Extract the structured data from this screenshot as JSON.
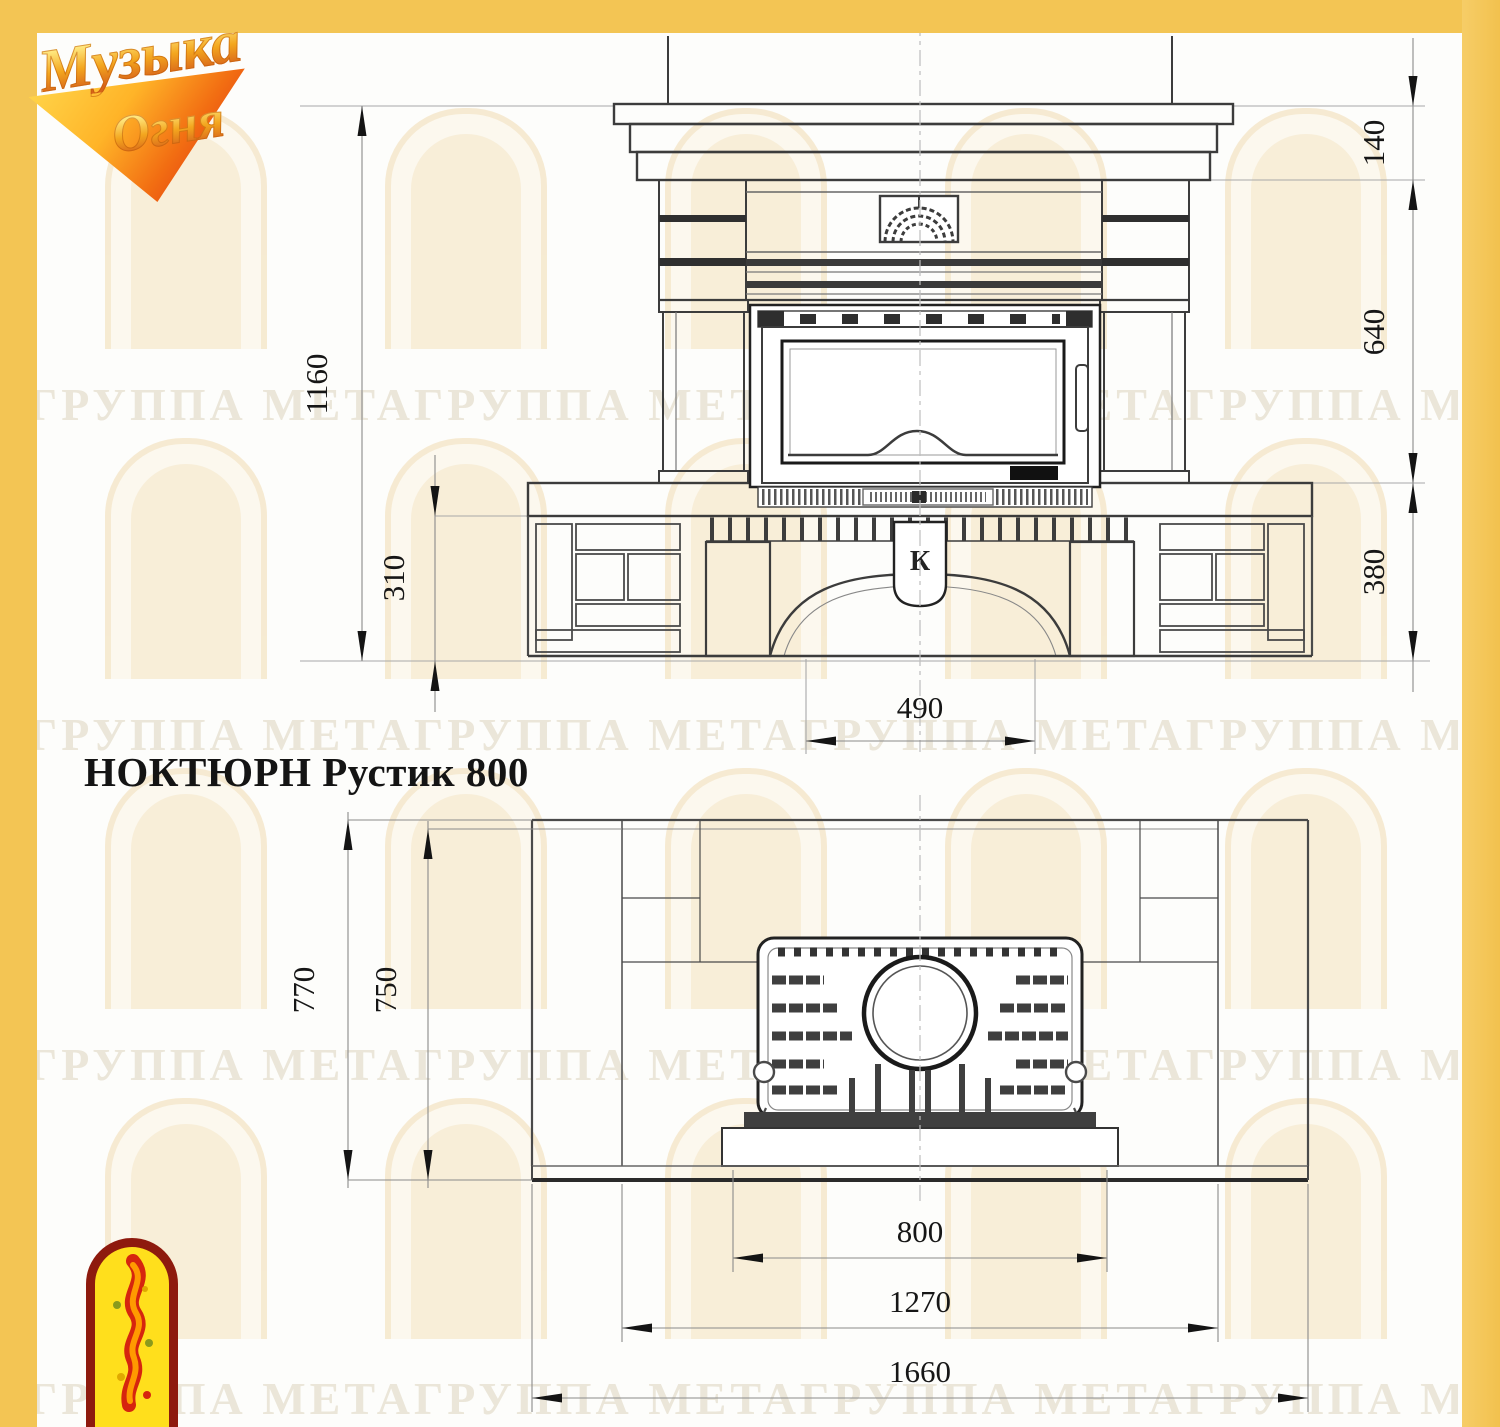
{
  "frame": {
    "color": "#f3c554"
  },
  "logo": {
    "word1": "Музыка",
    "word2": "Огня"
  },
  "watermark": {
    "row_text": "ГРУППА МЕТАГРУППА МЕТАГРУППА МЕТАГРУППА МЕТА"
  },
  "title": {
    "text": "НОКТЮРН Рустик 800"
  },
  "front_view": {
    "emblem_letter": "К",
    "dims": {
      "height_total": "1160",
      "base_height": "310",
      "shelf_thickness": "140",
      "body_height": "640",
      "hearth_to_floor": "380",
      "opening_width": "490"
    }
  },
  "plan_view": {
    "dims": {
      "depth_total": "770",
      "depth_body": "750",
      "firebox_width": "800",
      "body_width": "1270",
      "overall_width": "1660"
    }
  }
}
